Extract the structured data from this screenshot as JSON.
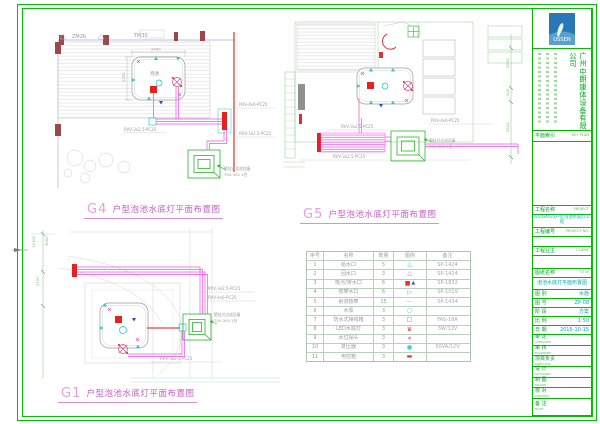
{
  "frame": {
    "color": "#00c400"
  },
  "drawings": {
    "g4": {
      "code": "G4",
      "caption": "户型泡池水底灯平面布置图",
      "wall_label_1": "ZM26",
      "wall_label_2": "TM30",
      "pool_label": "泡池",
      "dim_top": "2400",
      "dim_left": "2200",
      "cable_feed": "RVV-4x6-PC25",
      "cable_branch": "RVV-3x2.5-PC25",
      "cable_pool": "RVV-3x2.5-PC25",
      "equip_1": "壁挂式过滤设备",
      "equip_2": "700-300 1台"
    },
    "g5": {
      "code": "G5",
      "caption": "户型泡池水底灯平面布置图",
      "cable_feed": "RVV-4x6-PC25",
      "cable_branch": "RVV-3x2.5-PC25",
      "cable_pool": "RVV-3x2.5-PC25",
      "equip_1": "壁挂式过滤设备",
      "equip_2": "700-300 1台",
      "dims": [
        "3500",
        "500",
        "3500"
      ]
    },
    "g1": {
      "code": "G1",
      "caption": "户型泡池水底灯平面布置图",
      "dims": [
        "11300",
        "3000",
        "3100"
      ],
      "cable_feed": "RVV-4x6-PC25",
      "cable_branch": "RVV-3x2.5-PC25",
      "cable_pool": "RVV-3x2.5-PC25",
      "equip_1": "壁挂式过滤设备",
      "equip_2": "700-300 1台"
    }
  },
  "legend_table": {
    "headers": [
      "序号",
      "名称",
      "数量",
      "图例",
      "备注"
    ],
    "rows": [
      {
        "no": "1",
        "name": "给水口",
        "qty": "5",
        "symbol": "△",
        "symbol_color": "#2ec8c8",
        "remark": "SP-1424"
      },
      {
        "no": "2",
        "name": "回水口",
        "qty": "3",
        "symbol": "△",
        "symbol_color": "#c85fc8",
        "remark": "SP-1424"
      },
      {
        "no": "3",
        "name": "吸污/排水口",
        "qty": "6",
        "symbol": "■",
        "symbol_color": "#e83030",
        "symbol2": "▲",
        "symbol2_color": "#4455dd",
        "remark": "SP-1832"
      },
      {
        "no": "4",
        "name": "按摩水口",
        "qty": "6",
        "symbol": "▷",
        "symbol_color": "#2ec8c8",
        "remark": "SP-1019"
      },
      {
        "no": "5",
        "name": "射流按摩",
        "qty": "15",
        "symbol": "—",
        "symbol_color": "#b8b83a",
        "remark": "SP-1434"
      },
      {
        "no": "6",
        "name": "水泵",
        "qty": "3",
        "symbol": "○",
        "symbol_color": "#2ec8c8",
        "remark": ""
      },
      {
        "no": "7",
        "name": "防水式接线箱",
        "qty": "3",
        "symbol": "□",
        "symbol_color": "#30c030",
        "remark": "FAS-18A"
      },
      {
        "no": "8",
        "name": "LED水底灯",
        "qty": "3",
        "symbol": "♛",
        "symbol_color": "#e83030",
        "remark": "3W/12V"
      },
      {
        "no": "9",
        "name": "水位探头",
        "qty": "3",
        "symbol": "∗",
        "symbol_color": "#c85fc8",
        "remark": ""
      },
      {
        "no": "10",
        "name": "变压器",
        "qty": "3",
        "symbol": "●",
        "symbol_color": "#2ed8d8",
        "remark": "50VA/12V"
      },
      {
        "no": "11",
        "name": "电控箱",
        "qty": "3",
        "symbol": "▬",
        "symbol_color": "#e83030",
        "remark": ""
      }
    ]
  },
  "titleblock": {
    "logo_text": "USSEN",
    "company": "广州中朗康体设备有限公司",
    "keyplan": {
      "label": "平面索引",
      "en": "KEY PLAN"
    },
    "project": {
      "label": "工程名称",
      "en": "PROJECT",
      "value": "G1/G4/G5户型泡池水底灯工程"
    },
    "project_no": {
      "label": "工程编号",
      "en": "PROJECT NO."
    },
    "client": {
      "label": "工程业主",
      "en": "CLIENT"
    },
    "title": {
      "label": "图纸名称",
      "en": "TITLE",
      "value": "泡池水底灯平面布置图"
    },
    "info_rows": [
      {
        "label": "图 别",
        "value": "水施"
      },
      {
        "label": "图 号",
        "value": "ZP-08"
      },
      {
        "label": "阶 段",
        "value": "方案"
      },
      {
        "label": "比 例",
        "value": "1:50"
      },
      {
        "label": "日 期",
        "value": "2015-10-15"
      }
    ],
    "sign_rows": [
      {
        "label": "审 定",
        "en": "APPROVED"
      },
      {
        "label": "审 核",
        "en": "EXAMINED"
      },
      {
        "label": "项目负责",
        "en": "DIRECTOR"
      },
      {
        "label": "设 计",
        "en": "DESIGNED"
      },
      {
        "label": "制 图",
        "en": "DRAWN"
      },
      {
        "label": "校 对",
        "en": "CHECKED"
      }
    ],
    "note": {
      "label": "备 注",
      "en": "NOTE"
    }
  }
}
